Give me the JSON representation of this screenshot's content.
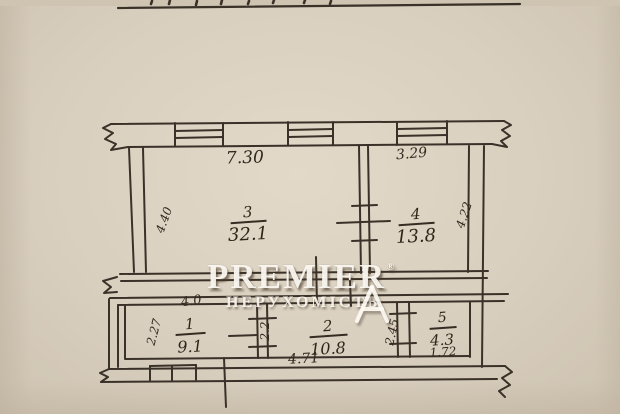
{
  "watermark": {
    "brand": "PREMIER",
    "registered": "®",
    "subtitle": "НЕРУХОМІСТЬ"
  },
  "rooms": {
    "room3": {
      "number": "3",
      "area": "32.1"
    },
    "room4": {
      "number": "4",
      "area": "13.8"
    },
    "room1": {
      "number": "1",
      "area": "9.1"
    },
    "room2": {
      "number": "2",
      "area": "10.8"
    },
    "room5": {
      "number": "5",
      "area": "4.3"
    }
  },
  "dimensions": {
    "room3_width": "7.30",
    "room4_width": "3.29",
    "room3_height": "4.40",
    "room4_height": "4.22",
    "room1_top": "4.0",
    "room1_left": "2.27",
    "partition_1_2": "2.2",
    "room2_bottom": "4.71",
    "partition_2_5": "2.45",
    "room5_bottom": "1.72"
  },
  "colors": {
    "ink": "#3a3128",
    "paper": "#d9cfbf",
    "watermark": "#fffcf6"
  }
}
